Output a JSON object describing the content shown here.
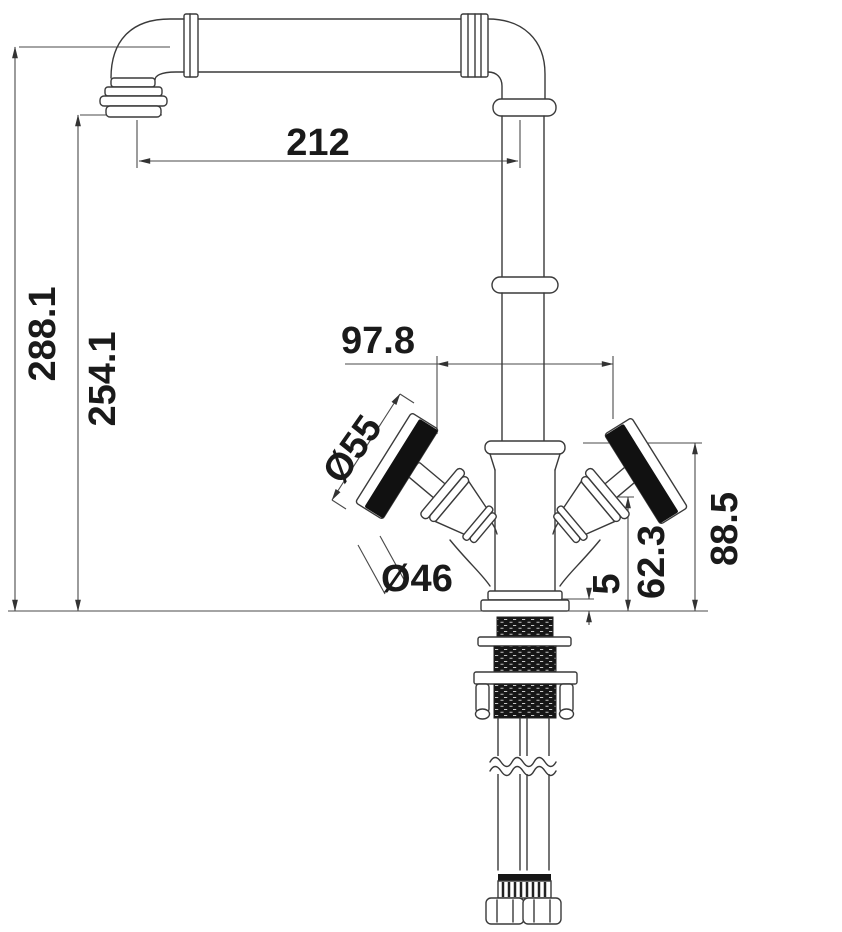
{
  "drawing": {
    "title": "Kitchen mixer tap dimensional drawing",
    "colors": {
      "background": "#ffffff",
      "outline": "#3a3a3a",
      "dimension_line": "#4a4a4a",
      "text": "#1a1a1a",
      "handle_fill": "#111111"
    },
    "dims": {
      "spout_reach": "212",
      "overall_height": "288.1",
      "spout_outlet_height": "254.1",
      "handle_span": "97.8",
      "handle_diameter": "Ø55",
      "body_diameter": "Ø46",
      "base_plate_height": "5",
      "valve_height": "62.3",
      "handle_height": "88.5"
    }
  }
}
